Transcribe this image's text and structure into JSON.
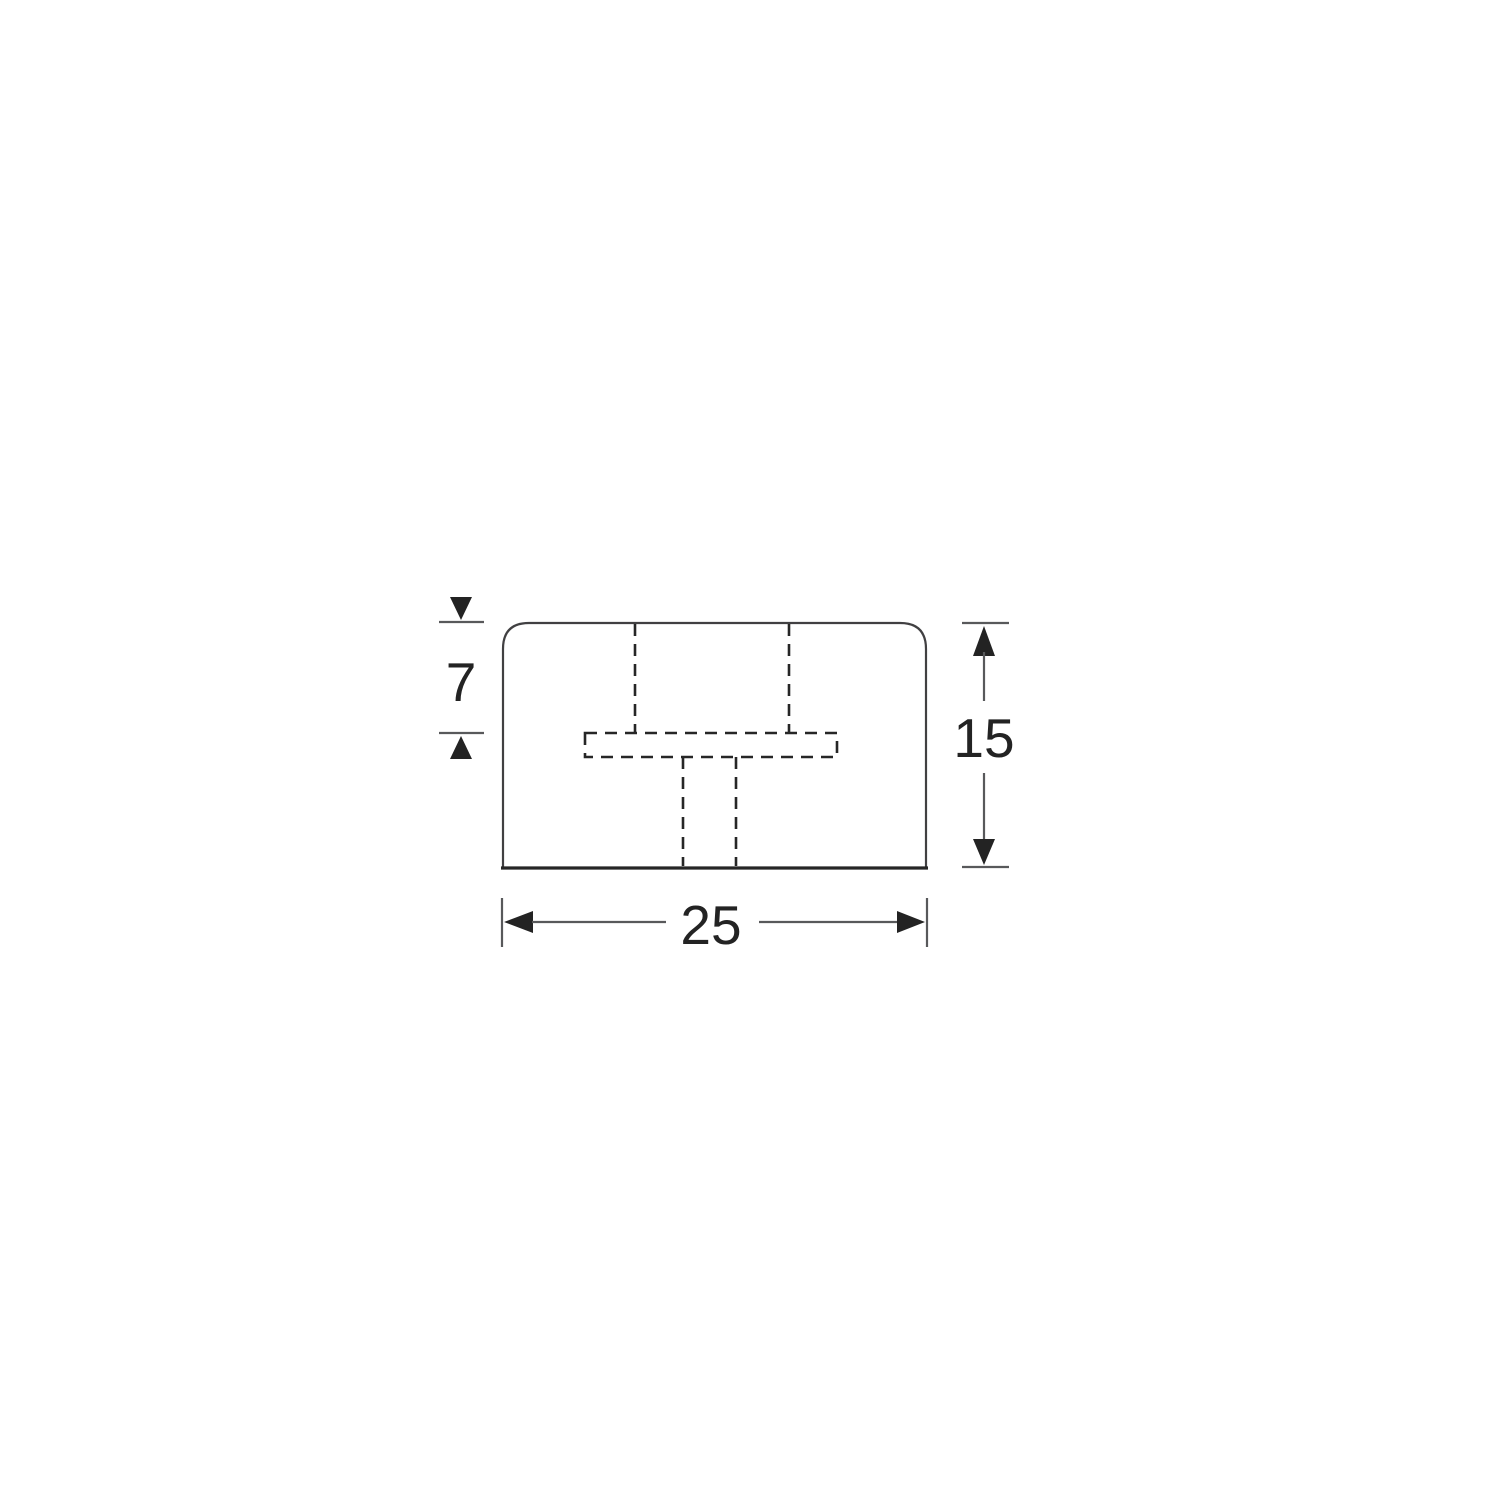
{
  "diagram": {
    "type": "technical-drawing",
    "dimensions": {
      "width": {
        "label": "25"
      },
      "height": {
        "label": "15"
      },
      "inset_depth": {
        "label": "7"
      }
    },
    "colors": {
      "outline": "#414042",
      "hidden_line": "#262626",
      "dimension_line": "#58595b",
      "arrow": "#232323",
      "text": "#232323",
      "background": "#ffffff"
    }
  }
}
